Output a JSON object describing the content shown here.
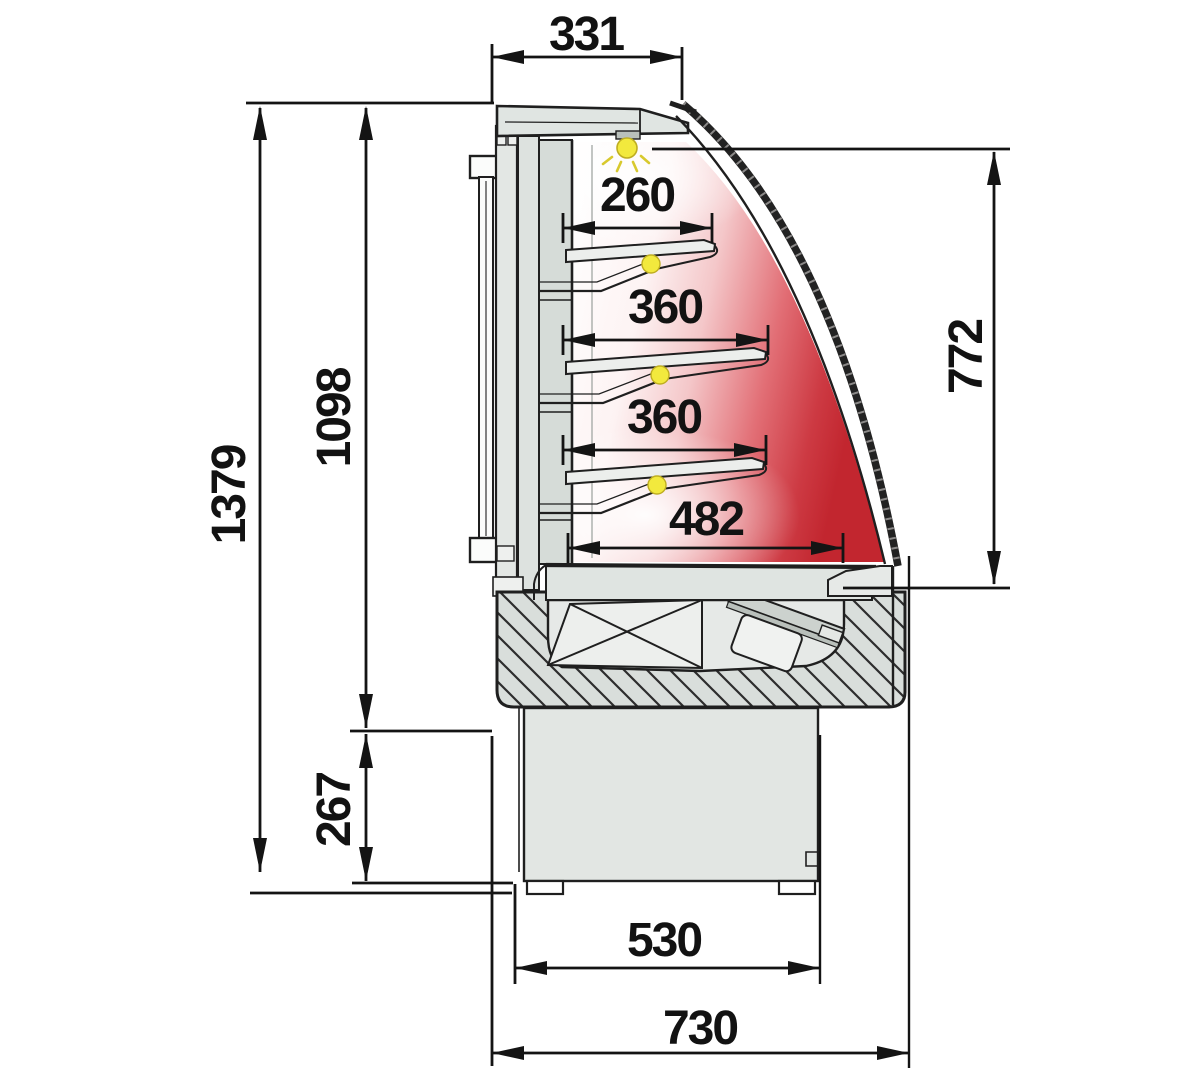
{
  "diagram": {
    "kind": "technical-cross-section",
    "subject": "refrigerated curved-glass display case, side section view"
  },
  "dimensions": {
    "top_depth": "331",
    "overall_height": "1379",
    "display_height": "1098",
    "plinth_height": "267",
    "front_glass_height": "772",
    "shelf_top_depth": "260",
    "shelf_middle_depth": "360",
    "shelf_lower_depth": "360",
    "base_deck_depth": "482",
    "plinth_width": "530",
    "overall_depth": "730"
  },
  "colors": {
    "line": "#1f1f1f",
    "panel_gray": "#e0e5e2",
    "hatch_gray": "#d9dedb",
    "interior_red": "#c42a33",
    "lamp_yellow": "#f2e93d",
    "background": "#ffffff"
  }
}
